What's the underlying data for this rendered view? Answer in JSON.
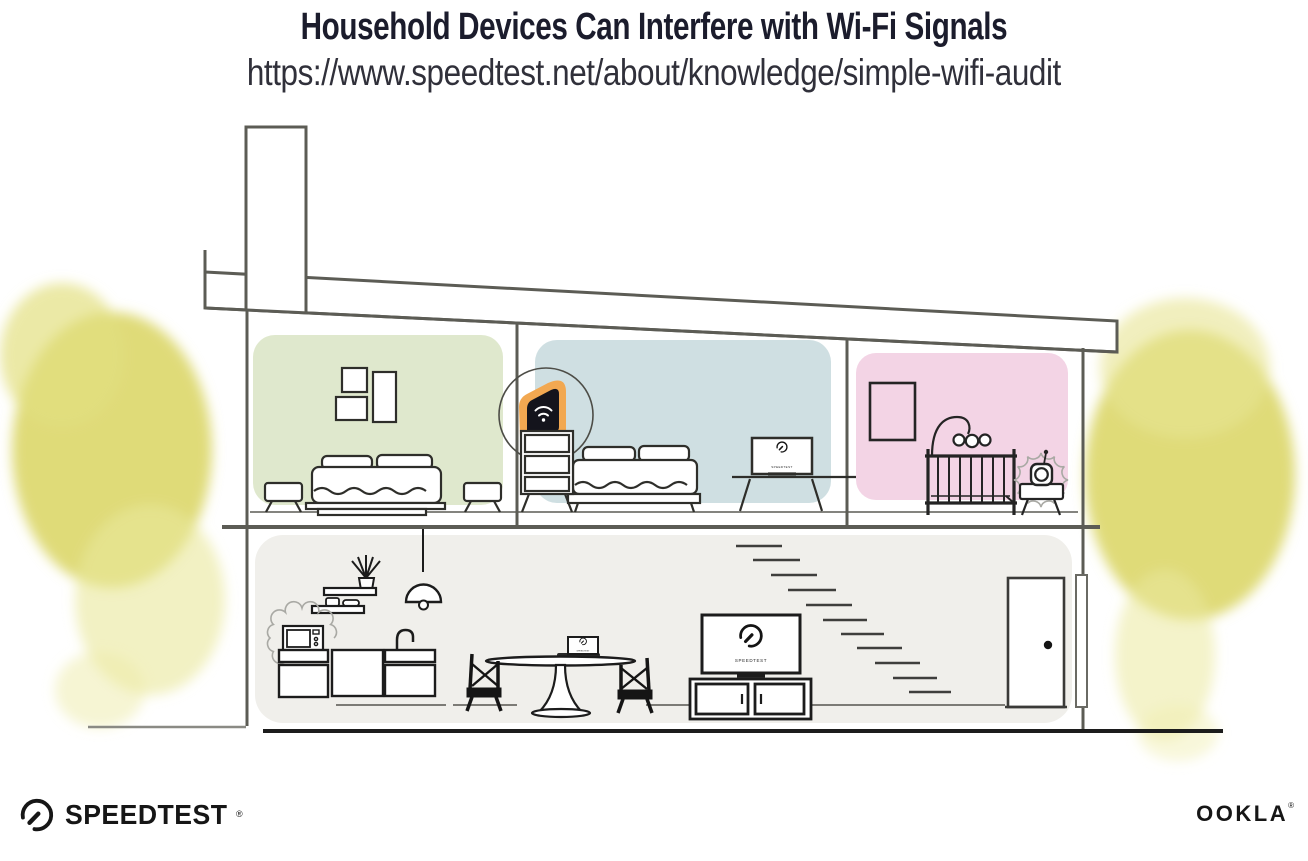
{
  "header": {
    "title": "Household Devices Can Interfere with Wi-Fi Signals",
    "url": "https://www.speedtest.net/about/knowledge/simple-wifi-audit"
  },
  "branding": {
    "speedtest_wordmark": "SPEEDTEST",
    "speedtest_trademark": "®",
    "ookla_wordmark": "OOKLA",
    "ookla_trademark": "®"
  },
  "illustration": {
    "screen_brand_label": "SPEEDTEST",
    "rooms": [
      {
        "name": "bedroom-left",
        "wall_color": "#dfe8cd"
      },
      {
        "name": "bedroom-middle",
        "wall_color": "#cfdfe2"
      },
      {
        "name": "nursery",
        "wall_color": "#f3d4e5"
      },
      {
        "name": "downstairs-living-area",
        "wall_color": "#f0efeb"
      }
    ],
    "router_highlight_color": "#f2a851",
    "tree_color": "#dbd76a",
    "devices": [
      "wifi-router",
      "baby-monitor",
      "microwave",
      "tv",
      "laptop",
      "desktop-monitor"
    ]
  }
}
